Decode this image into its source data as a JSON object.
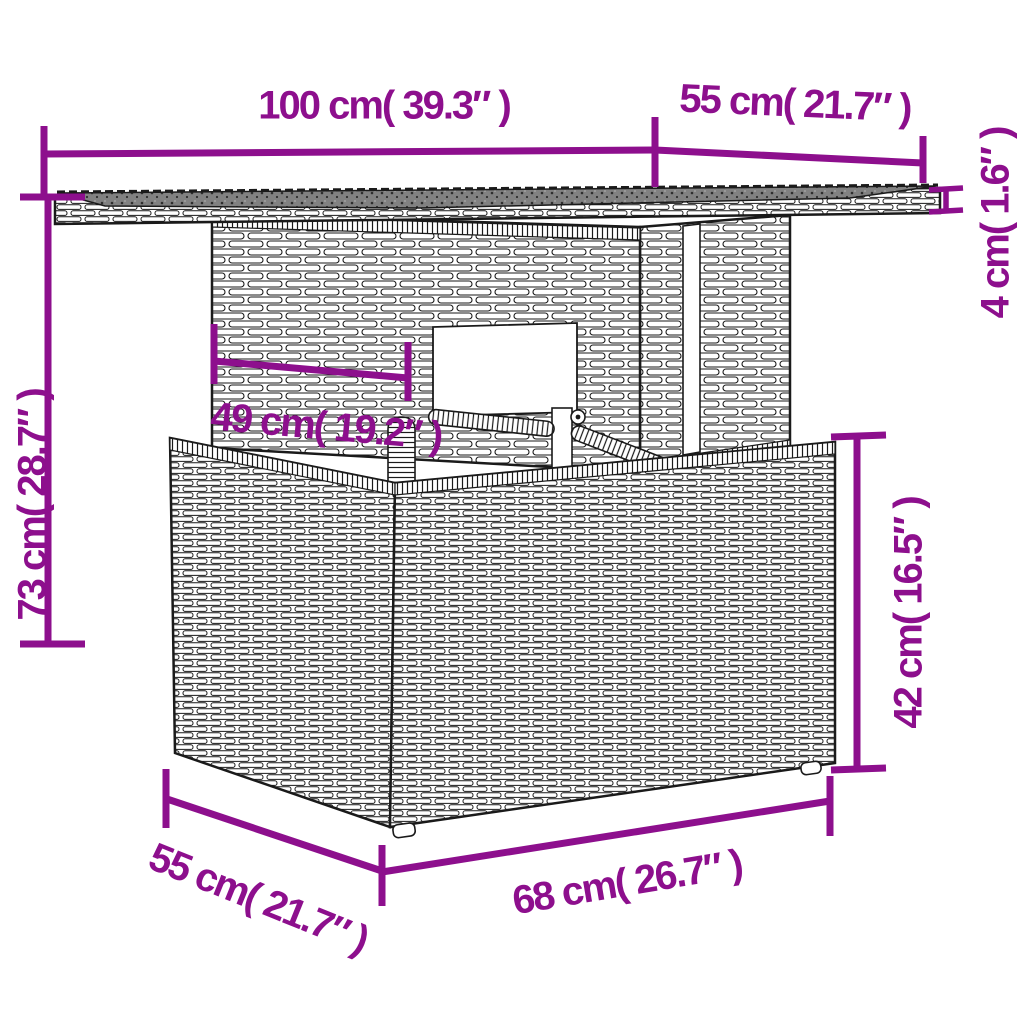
{
  "diagram": {
    "kind": "product-dimension-diagram",
    "subject": "poly rattan outdoor table line drawing with glass top, adjustable pedestal and box base",
    "accent_color": "#8D0F8D",
    "line_art_color": "#1a1a1a",
    "background_color": "#ffffff"
  },
  "dims": [
    {
      "id": "top-width",
      "label": "100 cm( 39.3″ )"
    },
    {
      "id": "top-depth",
      "label": "55 cm( 21.7″ )"
    },
    {
      "id": "tabletop-thickness",
      "label": "4 cm( 1.6″ )"
    },
    {
      "id": "total-height",
      "label": "73 cm( 28.7″ )"
    },
    {
      "id": "inner-width",
      "label": "49 cm( 19.2″ )"
    },
    {
      "id": "base-height",
      "label": "42 cm( 16.5″ )"
    },
    {
      "id": "base-depth",
      "label": "55 cm( 21.7″ )"
    },
    {
      "id": "base-width",
      "label": "68 cm( 26.7″ )"
    }
  ]
}
